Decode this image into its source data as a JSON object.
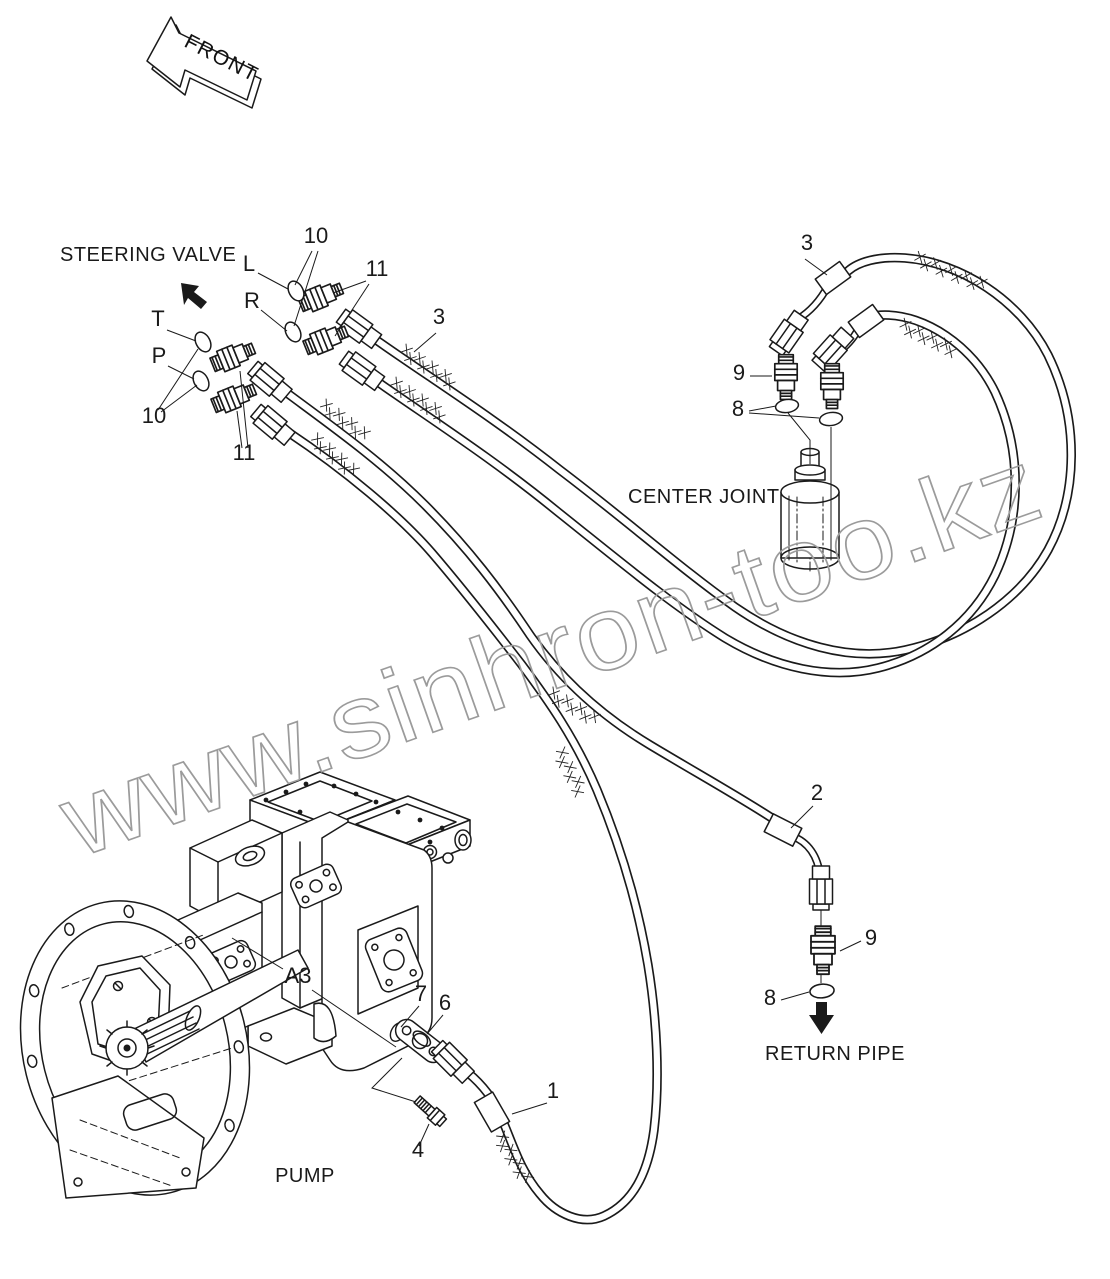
{
  "diagram": {
    "front_arrow": "FRONT",
    "watermark": "www.sinhron-too.kz",
    "colors": {
      "ink": "#1a1a1a",
      "watermark_gray": "#9b9b9b"
    },
    "area_labels": {
      "steering_valve": "STEERING VALVE",
      "center_joint": "CENTER JOINT",
      "return_pipe": "RETURN PIPE",
      "pump": "PUMP"
    },
    "port_labels": {
      "l": "L",
      "r": "R",
      "t": "T",
      "p": "P"
    },
    "callouts": {
      "oring_group_top": "10",
      "adapter_group_top": "11",
      "hose_steering_left": "3",
      "oring_group_bottom": "10",
      "adapter_group_bottom": "11",
      "hose_steering_right": "3",
      "adapter_center_joint": "9",
      "oring_center_joint": "8",
      "hose_return": "2",
      "adapter_return": "9",
      "oring_return": "8",
      "hose_pump": "1",
      "bolt": "4",
      "split_flange": "6",
      "oring_pump": "7",
      "pump_port": "A3"
    }
  }
}
